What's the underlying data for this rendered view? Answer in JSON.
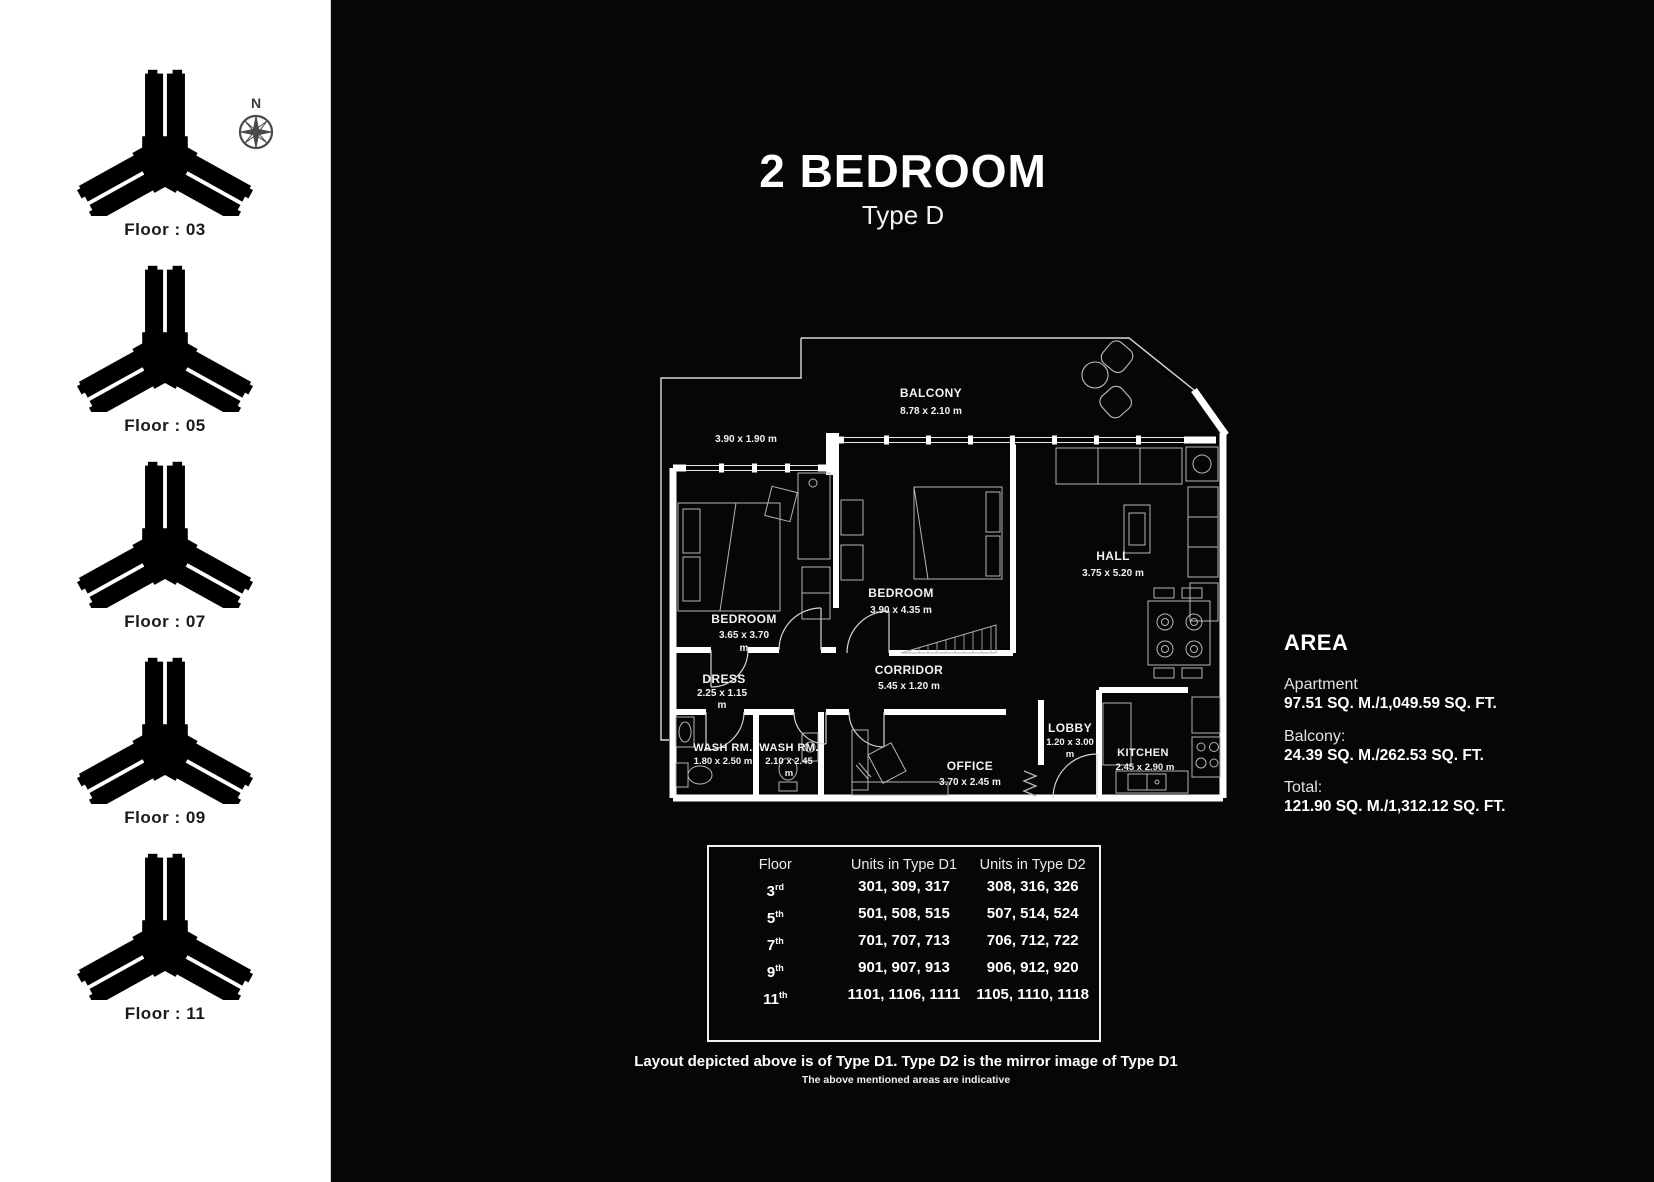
{
  "header": {
    "title": "2 BEDROOM",
    "subtitle": "Type D"
  },
  "sidebar": {
    "compass_label": "N",
    "floors": [
      {
        "label": "Floor : 03"
      },
      {
        "label": "Floor : 05"
      },
      {
        "label": "Floor : 07"
      },
      {
        "label": "Floor : 09"
      },
      {
        "label": "Floor : 11"
      }
    ]
  },
  "floorplan": {
    "rooms": [
      {
        "name": "BALCONY",
        "dims": "8.78 x 2.10 m"
      },
      {
        "name": "",
        "dims": "3.90 x 1.90 m"
      },
      {
        "name": "BEDROOM",
        "dims": "3.65 x 3.70",
        "dims2": "m"
      },
      {
        "name": "BEDROOM",
        "dims": "3.90 x 4.35 m"
      },
      {
        "name": "HALL",
        "dims": "3.75 x 5.20 m"
      },
      {
        "name": "DRESS",
        "dims": "2.25 x 1.15",
        "dims2": "m"
      },
      {
        "name": "CORRIDOR",
        "dims": "5.45 x 1.20 m"
      },
      {
        "name": "WASH RM.",
        "dims": "1.80 x 2.50 m"
      },
      {
        "name": "WASH RM.",
        "dims": "2.10 x 2.45",
        "dims2": "m"
      },
      {
        "name": "OFFICE",
        "dims": "3.70 x 2.45 m"
      },
      {
        "name": "LOBBY",
        "dims": "1.20 x 3.00",
        "dims2": "m"
      },
      {
        "name": "KITCHEN",
        "dims": "2.45 x 2.90 m"
      }
    ]
  },
  "area": {
    "heading": "AREA",
    "items": [
      {
        "label": "Apartment",
        "value": "97.51 SQ. M./1,049.59 SQ. FT."
      },
      {
        "label": "Balcony:",
        "value": "24.39 SQ. M./262.53 SQ. FT."
      },
      {
        "label": "Total:",
        "value": "121.90 SQ. M./1,312.12 SQ. FT."
      }
    ]
  },
  "units_table": {
    "headers": [
      "Floor",
      "Units in Type D1",
      "Units in Type D2"
    ],
    "rows": [
      {
        "floor": "3",
        "ord": "rd",
        "d1": "301, 309, 317",
        "d2": "308, 316, 326"
      },
      {
        "floor": "5",
        "ord": "th",
        "d1": "501, 508, 515",
        "d2": "507, 514, 524"
      },
      {
        "floor": "7",
        "ord": "th",
        "d1": "701, 707, 713",
        "d2": "706, 712, 722"
      },
      {
        "floor": "9",
        "ord": "th",
        "d1": "901, 907, 913",
        "d2": "906, 912, 920"
      },
      {
        "floor": "11",
        "ord": "th",
        "d1": "1101, 1106, 1111",
        "d2": "1105, 1110, 1118"
      }
    ]
  },
  "footer": {
    "line1": "Layout depicted above is of Type D1. Type D2 is the mirror image of Type D1",
    "line2": "The above mentioned areas are indicative"
  },
  "colors": {
    "background": "#070506",
    "sidebar": "#ffffff",
    "walls": "#ffffff",
    "key_shade": "#dcdcd6"
  }
}
